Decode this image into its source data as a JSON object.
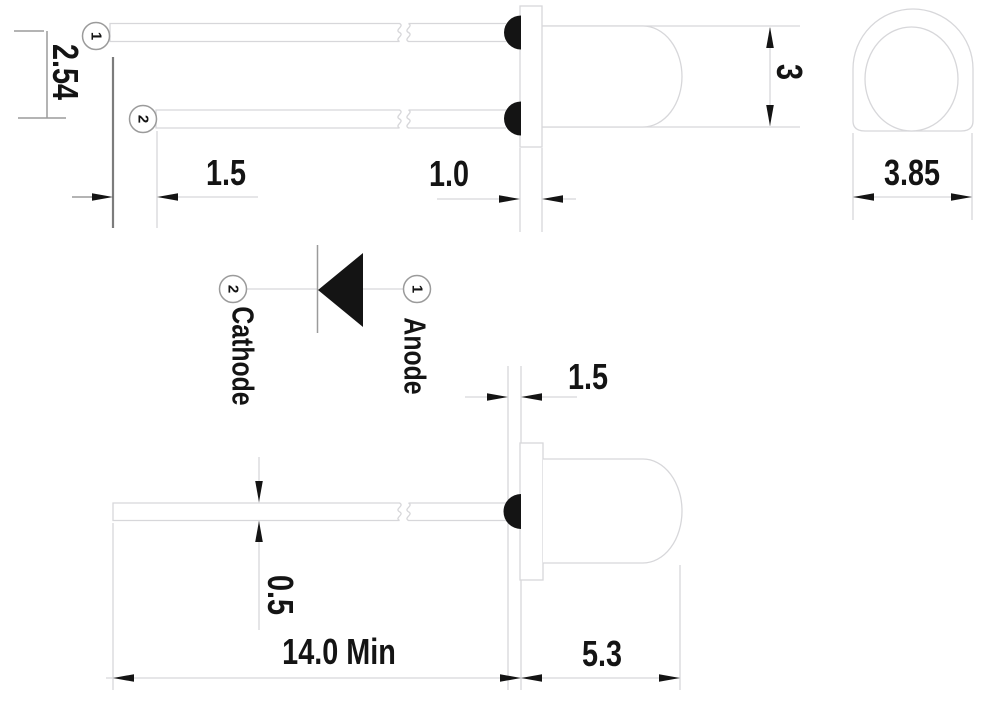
{
  "title": "LED package outline drawing",
  "colors": {
    "background": "#ffffff",
    "line_light": "#d7d7da",
    "line_medium": "#9b9b9b",
    "line_dark": "#7c7c7c",
    "ink": "#141414"
  },
  "pins": {
    "pin1": "1",
    "pin2": "2"
  },
  "schematic": {
    "cathode": "Cathode",
    "anode": "Anode"
  },
  "dimensions": {
    "lead_pitch": "2.54",
    "lead_offset_top": "1.5",
    "flange_thickness": "1.0",
    "body_diameter": "3",
    "flange_diameter": "3.85",
    "tip_standoff": "1.5",
    "lead_thickness": "0.5",
    "lead_length_min": "14.0 Min",
    "body_length": "5.3"
  }
}
